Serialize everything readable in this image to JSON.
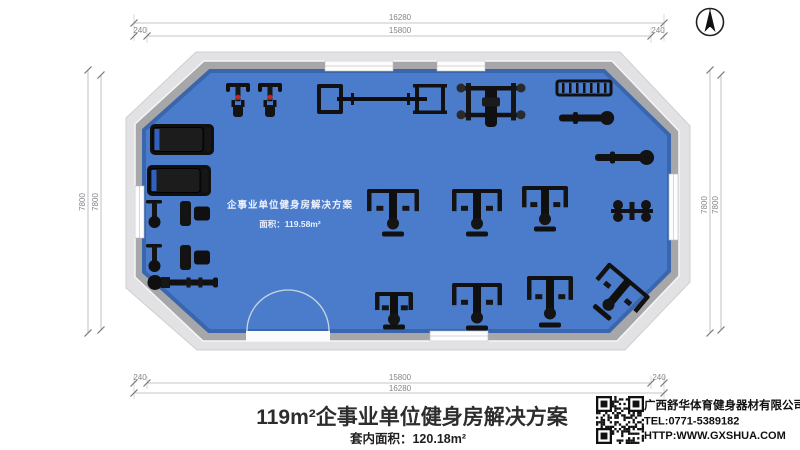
{
  "sheet": {
    "background": "#ffffff"
  },
  "icons": {
    "compass": "north-arrow-compass",
    "qr": "qr-code"
  },
  "dimensions": {
    "top": {
      "outer": "16280",
      "inner": "15800",
      "left_offset": "240",
      "right_offset": "240"
    },
    "bottom": {
      "outer": "16280",
      "inner": "15800",
      "left_offset": "240",
      "right_offset": "240"
    },
    "left": {
      "outer": "7800",
      "inner": "7800"
    },
    "right": {
      "outer": "7800",
      "inner": "7800"
    }
  },
  "plan": {
    "watermark_line1": "企事业单位健身房解决方案",
    "watermark_line2": "面积：119.58m²",
    "floor_color": "#4b7ccb",
    "wall_color": "#a7a7aa",
    "apron_color": "#e2e2e4",
    "equipment": [
      {
        "name": "treadmill-1",
        "kind": "treadmill",
        "x": 150,
        "y": 124,
        "w": 64,
        "h": 31
      },
      {
        "name": "treadmill-2",
        "kind": "treadmill",
        "x": 147,
        "y": 165,
        "w": 64,
        "h": 31
      },
      {
        "name": "upright-bike-1",
        "kind": "bike",
        "x": 226,
        "y": 83,
        "w": 24,
        "h": 34
      },
      {
        "name": "upright-bike-2",
        "kind": "bike",
        "x": 258,
        "y": 83,
        "w": 24,
        "h": 34
      },
      {
        "name": "barbell-rack",
        "kind": "rack",
        "x": 317,
        "y": 84,
        "w": 130,
        "h": 30
      },
      {
        "name": "bench-press-station",
        "kind": "station",
        "x": 457,
        "y": 83,
        "w": 68,
        "h": 48
      },
      {
        "name": "dumbbell-rack",
        "kind": "dumbrack",
        "x": 557,
        "y": 81,
        "w": 54,
        "h": 14
      },
      {
        "name": "flat-bench-1",
        "kind": "bench",
        "x": 559,
        "y": 110,
        "w": 56,
        "h": 16
      },
      {
        "name": "flat-bench-2",
        "kind": "bench",
        "x": 595,
        "y": 149,
        "w": 60,
        "h": 17
      },
      {
        "name": "spin-bike-pair-1",
        "kind": "bikerow",
        "x": 146,
        "y": 199,
        "w": 64,
        "h": 29
      },
      {
        "name": "spin-bike-pair-2",
        "kind": "bikerow",
        "x": 146,
        "y": 243,
        "w": 64,
        "h": 29
      },
      {
        "name": "rowing-machine",
        "kind": "rower",
        "x": 148,
        "y": 272,
        "w": 70,
        "h": 21
      },
      {
        "name": "cable-machine",
        "kind": "machine",
        "x": 367,
        "y": 189,
        "w": 52,
        "h": 48
      },
      {
        "name": "pec-fly-machine",
        "kind": "machine",
        "x": 452,
        "y": 189,
        "w": 50,
        "h": 48
      },
      {
        "name": "lat-pulldown-machine",
        "kind": "machine",
        "x": 522,
        "y": 186,
        "w": 46,
        "h": 46
      },
      {
        "name": "adjustable-bench",
        "kind": "smallmachine",
        "x": 611,
        "y": 197,
        "w": 42,
        "h": 28
      },
      {
        "name": "leg-press-machine",
        "kind": "machine",
        "x": 375,
        "y": 292,
        "w": 38,
        "h": 38
      },
      {
        "name": "shoulder-press-machine",
        "kind": "machine",
        "x": 452,
        "y": 283,
        "w": 50,
        "h": 48
      },
      {
        "name": "leg-extension-machine",
        "kind": "machine",
        "x": 527,
        "y": 276,
        "w": 46,
        "h": 52
      },
      {
        "name": "incline-press-machine",
        "kind": "machine",
        "x": 588,
        "y": 274,
        "w": 54,
        "h": 46,
        "rot": 40
      }
    ]
  },
  "footer": {
    "title": "119m²企事业单位健身房解决方案",
    "subtitle": "套内面积：120.18m²"
  },
  "company": {
    "name": "广西舒华体育健身器材有限公司",
    "tel": "TEL:0771-5389182",
    "website": "HTTP:WWW.GXSHUA.COM"
  }
}
